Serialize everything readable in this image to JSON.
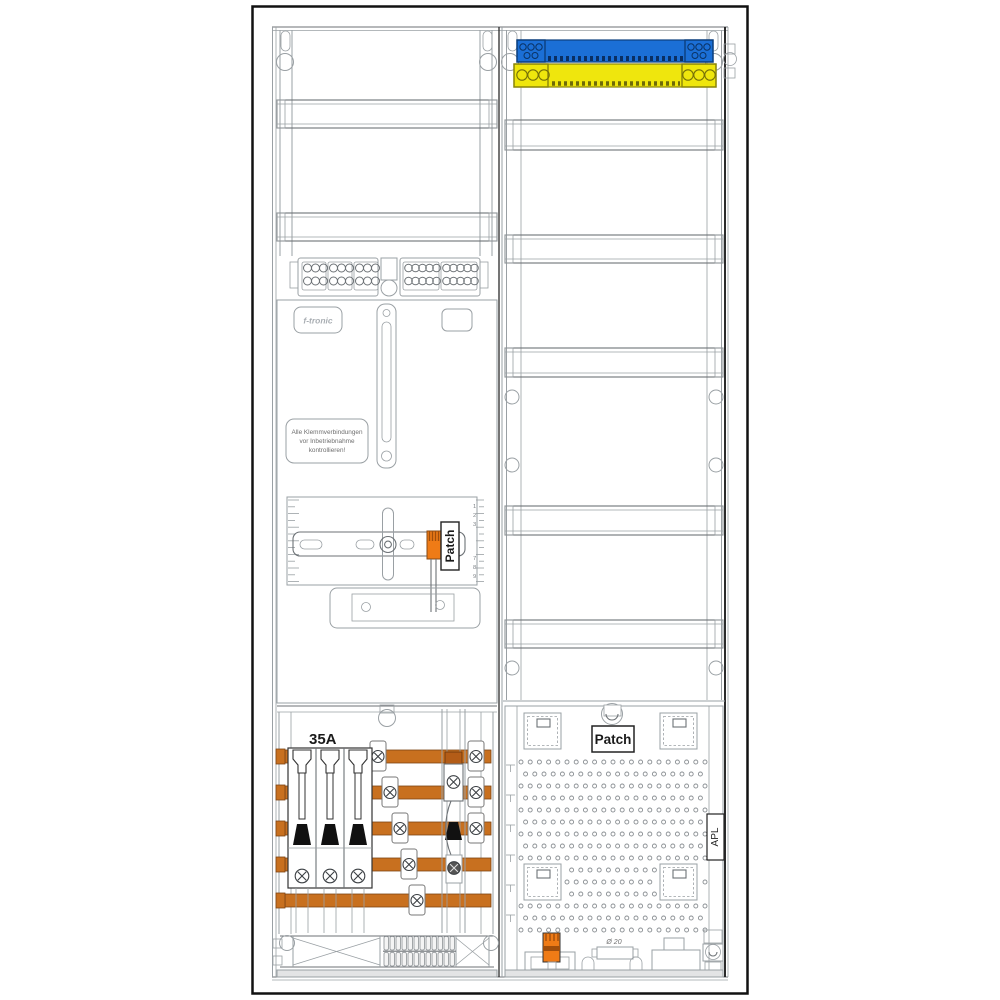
{
  "drawing": {
    "type": "meter-cabinet-wiring-diagram",
    "left_field": {
      "brand_label": "f-tronic",
      "notice_sticker": {
        "line1": "Alle Klemmverbindungen",
        "line2": "vor Inbetriebnahme",
        "line3": "kontrollieren!"
      },
      "meter_bracket": {
        "patch_label": "Patch",
        "ruler_numbers_top": [
          "1",
          "2",
          "3"
        ],
        "ruler_numbers_bottom": [
          "7",
          "8",
          "9"
        ]
      },
      "fuse_section": {
        "rating_label": "35A",
        "breaker_count": 3,
        "busbar_count": 5
      }
    },
    "right_field": {
      "neutral_rail": "N rail (blue)",
      "pe_rail": "PE rail (yellow)",
      "apl_panel": {
        "patch_label": "Patch",
        "side_label": "APL",
        "gland_label": "Ø 20"
      }
    }
  },
  "colors": {
    "neutral_rail_blue": "#1b6fd6",
    "pe_rail_yellow": "#efe60d",
    "busbar_copper": "#c8701f",
    "terminal_orange": "#ef7b16",
    "terminal_orange_dark": "#b35c17",
    "line_gray": "#9aa0a4",
    "line_dark": "#2b2b2b"
  }
}
